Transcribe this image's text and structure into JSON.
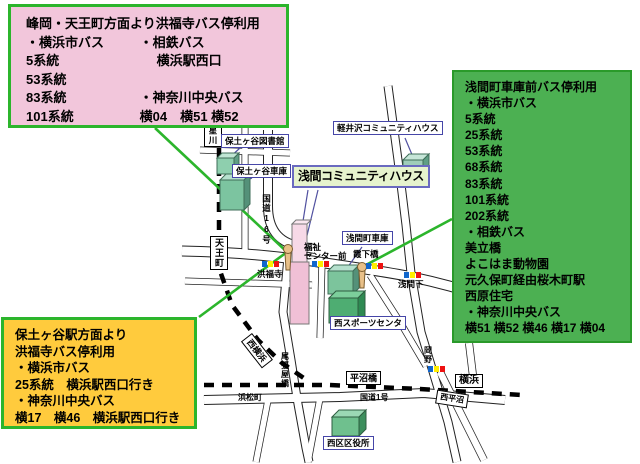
{
  "colors": {
    "pointer_green": "#2cb52c",
    "box_pink_bg": "#f2c6db",
    "box_green_bg": "#4cb052",
    "box_yellow_bg": "#ffcb3d",
    "building_green": "#8ecfae",
    "building_pink": "#f0c0d6",
    "busstop_blue": "#1166cc",
    "busstop_yellow": "#ffee00",
    "busstop_red": "#ee1111"
  },
  "info_boxes": {
    "minooka_pink": {
      "rows": [
        {
          "l": "峰岡・天王町方面より洪福寺バス停利用",
          "r": ""
        },
        {
          "l": "・横浜市バス",
          "r": "・相鉄バス"
        },
        {
          "l": "5系統",
          "r": "横浜駅西口"
        },
        {
          "l": "53系統",
          "r": ""
        },
        {
          "l": "83系統",
          "r": "・神奈川中央バス"
        },
        {
          "l": "101系統",
          "r": "横04　横51 横52"
        }
      ]
    },
    "sengen_green": {
      "lines": [
        "浅間町車庫前バス停利用",
        "・横浜市バス",
        "5系統",
        "25系統",
        "53系統",
        "68系統",
        "83系統",
        "101系統",
        "202系統",
        "・相鉄バス",
        "美立橋",
        "よこはま動物園",
        "元久保町経由桜木町駅",
        "西原住宅",
        "・神奈川中央バス",
        "横51 横52 横46 横17 横04"
      ]
    },
    "hodogaya_yellow": {
      "lines": [
        "保土ヶ谷駅方面より",
        "洪福寺バス停利用",
        "・横浜市バス",
        "25系統　横浜駅西口行き",
        "・神奈川中央バス",
        "横17　横46　横浜駅西口行き"
      ]
    }
  },
  "map": {
    "title_label": "浅間コミュニティハウス",
    "facility_labels": {
      "hodogaya_library": "保土ヶ谷図書館",
      "hodogaya_depot": "保土ヶ谷車庫",
      "karuizawa_house": "軽井沢コミュニティハウス",
      "sengen_depot": "浅間町車庫",
      "nishi_sports_center": "西スポーツセンタ",
      "nishi_ward_office": "西区区役所"
    },
    "station_labels": {
      "hoshikawa": "星川",
      "tennocho": "天王町",
      "nishi_yokohama": "西横浜",
      "hiranumabashi": "平沼橋",
      "yokohama": "横浜",
      "nishi_hiranuma": "西平沼"
    },
    "road_labels": {
      "kokudo16": "国道16号",
      "kokudo1": "国道1号",
      "owariyabashi": "尾張屋橋",
      "okano": "岡野",
      "hamamatsucho": "浜松町"
    },
    "spot_labels": {
      "kofukuji": "洪福寺",
      "fukushi_center_1": "福祉",
      "fukushi_center_2": "センター前",
      "kasumishitabashi": "霞下橋",
      "sengenshita": "浅間下"
    }
  }
}
